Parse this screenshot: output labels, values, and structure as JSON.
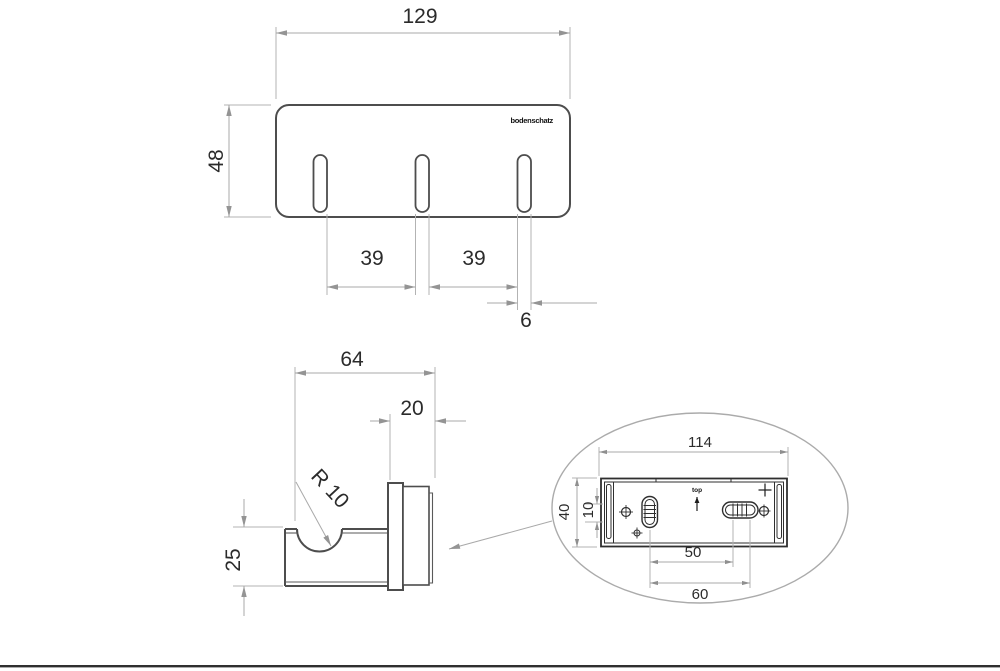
{
  "drawing": {
    "brand_logo": "bodenschatz",
    "front_view": {
      "overall_width": "129",
      "overall_height": "48",
      "hook_spacing_left": "39",
      "hook_spacing_right": "39",
      "slot_width": "6"
    },
    "side_view": {
      "overall_depth": "64",
      "mount_depth": "20",
      "hook_radius": "R 10",
      "hook_height": "25"
    },
    "rear_detail_view": {
      "plate_width": "114",
      "plate_height": "40",
      "slot_offset": "10",
      "hole_pitch_inner": "50",
      "hole_pitch_outer": "60",
      "orientation_label": "top"
    }
  }
}
